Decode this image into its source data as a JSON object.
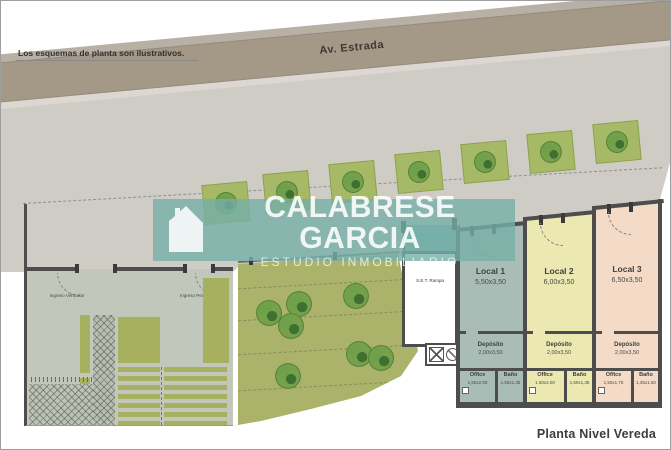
{
  "disclaimer": "Los esquemas de planta son ilustrativos.",
  "street": {
    "name": "Av. Estrada"
  },
  "watermark": {
    "title": "CALABRESE GARCIA",
    "subtitle": "ESTUDIO INMOBILIARIO"
  },
  "plan": {
    "title": "Planta Nivel Vereda",
    "entrances": {
      "vehicular": "Ingreso Vehicular",
      "peatonal": "Ingreso Peatonal"
    },
    "set_room": "S.E.T. Rampa",
    "locals": [
      {
        "name": "Local 1",
        "dims": "5,50x3,50",
        "color": "#a9bcb6",
        "deposito_label": "Depósito",
        "deposito_dims": "2,00x3,50",
        "office_label": "Office",
        "office_dims": "1,50x2,00",
        "bano_label": "Baño",
        "bano_dims": "1,50x1,35"
      },
      {
        "name": "Local 2",
        "dims": "6,00x3,50",
        "color": "#ebe8b1",
        "deposito_label": "Depósito",
        "deposito_dims": "2,00x3,50",
        "office_label": "Office",
        "office_dims": "1,50x2,00",
        "bano_label": "Baño",
        "bano_dims": "1,50x1,35"
      },
      {
        "name": "Local 3",
        "dims": "6,50x3,50",
        "color": "#f3dbc7",
        "deposito_label": "Depósito",
        "deposito_dims": "2,00x3,50",
        "office_label": "Office",
        "office_dims": "1,50x1,75",
        "bano_label": "Baño",
        "bano_dims": "1,35x1,50"
      }
    ]
  },
  "colors": {
    "street": "#a49887",
    "sidewalk": "#cfccc5",
    "plaza": "#c1c7ba",
    "lawn": "#abb36a",
    "planter": "#a6b966",
    "tree": "#4f8038",
    "wall": "#4d4d4d",
    "watermark_teal": "#76afa7"
  }
}
